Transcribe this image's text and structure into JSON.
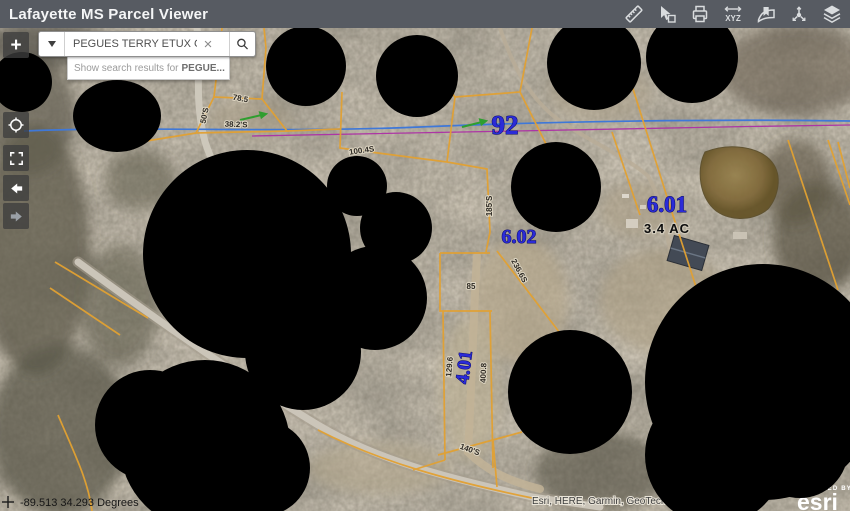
{
  "app": {
    "title": "Lafayette MS Parcel Viewer"
  },
  "toolbar": {
    "xyz_label": "XYZ",
    "icons": [
      {
        "name": "measure-icon"
      },
      {
        "name": "select-icon"
      },
      {
        "name": "print-icon"
      },
      {
        "name": "xyz-coordinates-icon"
      },
      {
        "name": "bookmark-icon"
      },
      {
        "name": "share-icon"
      },
      {
        "name": "layers-icon"
      }
    ]
  },
  "search": {
    "value": "PEGUES TERRY ETUX CH",
    "suggestion_prefix": "Show search results for",
    "suggestion_term": "PEGUE..."
  },
  "map_controls": {
    "zoom_in": "+"
  },
  "statusbar": {
    "coordinates": "-89.513 34.293 Degrees"
  },
  "attribution": {
    "sources": "Esri, HERE, Garmin, GeoTechnologies",
    "powered_by": "POWERED BY",
    "brand": "esri"
  },
  "map": {
    "parcel_labels": [
      {
        "text": "92"
      },
      {
        "text": "6.01"
      },
      {
        "text": "6.02"
      },
      {
        "text": "4.01"
      }
    ],
    "acreage_label": "3.4 AC",
    "dimension_labels": [
      {
        "text": "78.5"
      },
      {
        "text": "50'S"
      },
      {
        "text": "38.2'S"
      },
      {
        "text": "100.4S"
      },
      {
        "text": "185'S"
      },
      {
        "text": "85"
      },
      {
        "text": "236.6S"
      },
      {
        "text": "129.6"
      },
      {
        "text": "400.8"
      },
      {
        "text": "140'S"
      }
    ],
    "colors": {
      "parcel_line": "#e2a132",
      "stream": "#3f78d8",
      "survey_line": "#ad35a5",
      "parcel_label": "#2b2bd8",
      "redaction": "#000000"
    }
  }
}
